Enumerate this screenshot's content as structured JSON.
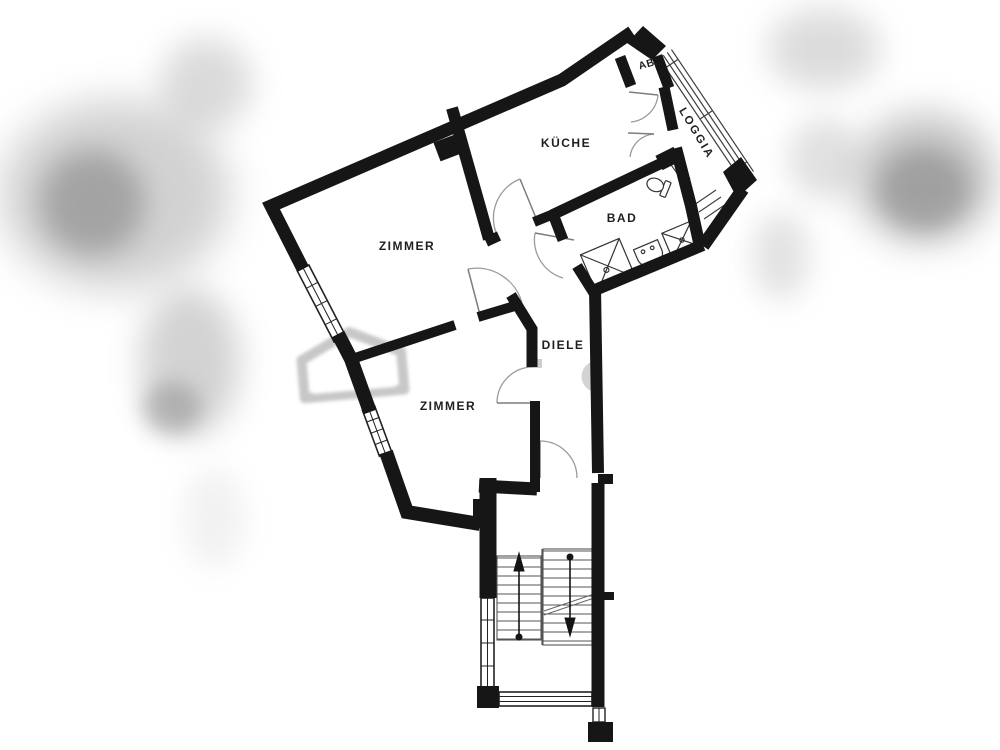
{
  "rooms": [
    {
      "id": "zimmer-upper",
      "label": "ZIMMER"
    },
    {
      "id": "kueche",
      "label": "KÜCHE"
    },
    {
      "id": "bad",
      "label": "BAD"
    },
    {
      "id": "zimmer-lower",
      "label": "ZIMMER"
    },
    {
      "id": "diele",
      "label": "DIELE"
    },
    {
      "id": "loggia",
      "label": "LOGGIA"
    },
    {
      "id": "abstellraum",
      "label": "AB."
    }
  ],
  "colors": {
    "wall": "#161616",
    "thin_line": "#3d3d3d",
    "door_arc": "#9a9a9a",
    "watermark": "#9b9b9b",
    "background": "#ffffff"
  }
}
